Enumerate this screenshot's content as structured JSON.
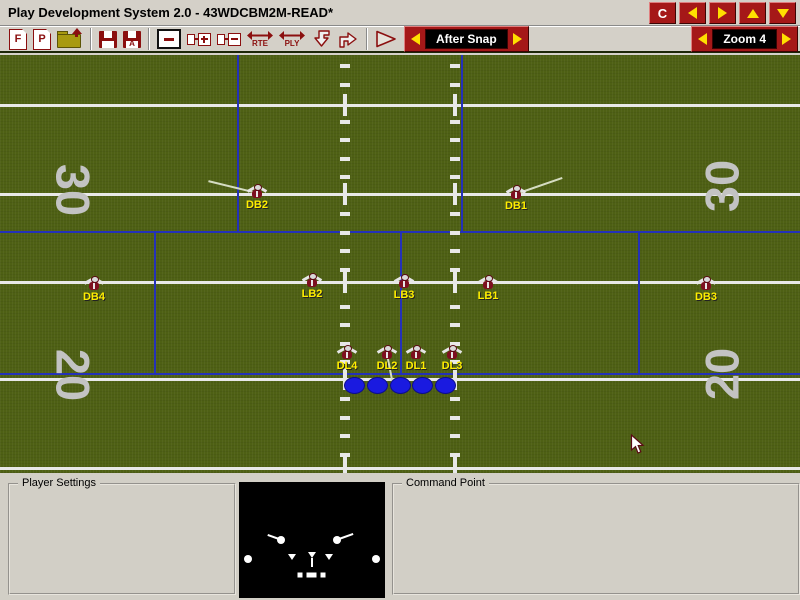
{
  "window": {
    "title": "Play Development System 2.0 - 43WDCBM2M-READ*",
    "titlebar_buttons": [
      {
        "name": "command-button",
        "label": "C"
      },
      {
        "name": "nav-left-button"
      },
      {
        "name": "nav-right-button"
      },
      {
        "name": "nav-up-button"
      },
      {
        "name": "nav-down-button"
      }
    ]
  },
  "toolbar": {
    "icons": [
      "new-formation-icon",
      "new-play-icon",
      "open-folder-icon",
      "save-icon",
      "save-as-icon",
      "remove-box-icon",
      "add-node-icon",
      "remove-node-icon",
      "route-mode-icon",
      "play-mode-icon",
      "arrow-down-icon",
      "arrow-right-icon",
      "run-play-icon"
    ],
    "icon_letters": {
      "formation": "F",
      "play": "P",
      "save_as": "A",
      "rte": "RTE",
      "ply": "PLY"
    },
    "phase_selector": {
      "value": "After Snap"
    },
    "zoom_selector": {
      "value": "Zoom 4"
    }
  },
  "colors": {
    "field_green": "#4e6014",
    "line_blue": "#2431b8",
    "label_yellow": "#ffee00",
    "maroon": "#7d0f1f",
    "button_red": "#a51818",
    "ol_blue": "#1a1ae0"
  },
  "field": {
    "yard_lines_y": [
      50,
      139,
      227,
      324,
      413
    ],
    "blue_h_lines_y": [
      177,
      319
    ],
    "blue_v_segments": [
      {
        "x": 238,
        "y1": 0,
        "y2": 177
      },
      {
        "x": 462,
        "y1": 0,
        "y2": 177
      },
      {
        "x": 155,
        "y1": 177,
        "y2": 319
      },
      {
        "x": 401,
        "y1": 177,
        "y2": 319
      },
      {
        "x": 639,
        "y1": 177,
        "y2": 319
      }
    ],
    "hash_columns_x": [
      345,
      455
    ],
    "hash_dash": {
      "start_y": 11,
      "step": 18.5,
      "end_y": 408,
      "skip_margin": 8
    },
    "yard_numbers": [
      {
        "text": "30",
        "side": "left",
        "cx": 73,
        "cy": 135
      },
      {
        "text": "30",
        "side": "right",
        "cx": 722,
        "cy": 131
      },
      {
        "text": "20",
        "side": "left",
        "cx": 73,
        "cy": 320
      },
      {
        "text": "20",
        "side": "right",
        "cx": 722,
        "cy": 319
      }
    ],
    "players": [
      {
        "label": "DB2",
        "cx": 257,
        "cy": 137,
        "route": [
          208,
          125
        ]
      },
      {
        "label": "DB1",
        "cx": 516,
        "cy": 138,
        "route": [
          562,
          122
        ]
      },
      {
        "label": "DB4",
        "cx": 94,
        "cy": 229
      },
      {
        "label": "LB2",
        "cx": 312,
        "cy": 226
      },
      {
        "label": "LB3",
        "cx": 404,
        "cy": 227
      },
      {
        "label": "LB1",
        "cx": 488,
        "cy": 228
      },
      {
        "label": "DB3",
        "cx": 706,
        "cy": 229
      },
      {
        "label": "DL4",
        "cx": 347,
        "cy": 298
      },
      {
        "label": "DL2",
        "cx": 387,
        "cy": 298,
        "route": [
          394,
          334
        ]
      },
      {
        "label": "DL1",
        "cx": 416,
        "cy": 298
      },
      {
        "label": "DL3",
        "cx": 452,
        "cy": 298
      }
    ],
    "offensive_linemen": [
      {
        "cx": 354,
        "cy": 330
      },
      {
        "cx": 377,
        "cy": 330
      },
      {
        "cx": 400,
        "cy": 330
      },
      {
        "cx": 422,
        "cy": 330
      },
      {
        "cx": 445,
        "cy": 330
      }
    ],
    "cursor": {
      "x": 630,
      "y": 379
    }
  },
  "panels": {
    "player_settings_label": "Player Settings",
    "command_point_label": "Command Point"
  },
  "preview": {
    "box": {
      "left": 239,
      "top": 9,
      "width": 146,
      "height": 116
    },
    "circles": [
      {
        "x": 42,
        "y": 58
      },
      {
        "x": 98,
        "y": 58
      },
      {
        "x": 9,
        "y": 77
      },
      {
        "x": 137,
        "y": 77
      }
    ],
    "lines": [
      {
        "x1": 40,
        "y1": 56,
        "x2": 29,
        "y2": 52
      },
      {
        "x1": 100,
        "y1": 56,
        "x2": 114,
        "y2": 51
      },
      {
        "x1": 73,
        "y1": 75,
        "x2": 73,
        "y2": 84
      }
    ],
    "triangles": [
      {
        "x": 53,
        "y": 75
      },
      {
        "x": 73,
        "y": 73
      },
      {
        "x": 90,
        "y": 75
      }
    ],
    "squares": [
      {
        "x": 61,
        "y": 93
      },
      {
        "x": 70,
        "y": 93
      },
      {
        "x": 75,
        "y": 93
      },
      {
        "x": 84,
        "y": 93
      }
    ]
  }
}
